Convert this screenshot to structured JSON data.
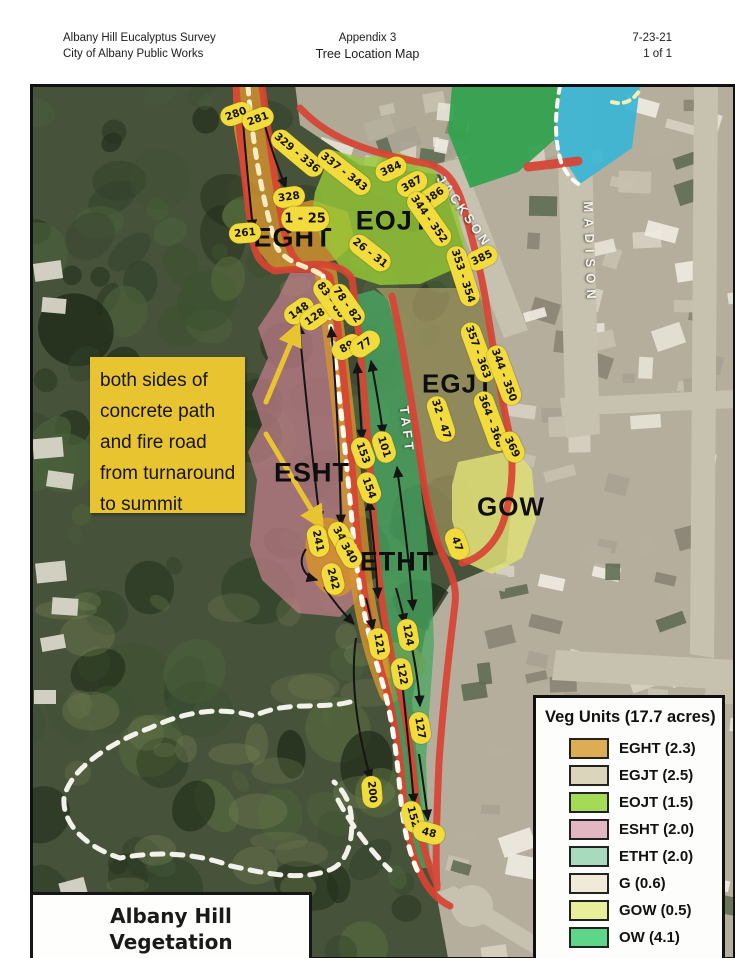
{
  "header": {
    "left_line1": "Albany Hill Eucalyptus Survey",
    "left_line2": "City of Albany Public Works",
    "center_line1": "Appendix 3",
    "center_line2": "Tree Location Map",
    "right_line1": "7-23-21",
    "right_line2": "1 of 1"
  },
  "map": {
    "callout": {
      "lines": [
        "both sides of",
        "concrete path",
        "and fire road",
        "from turnaround",
        "to summit"
      ]
    },
    "zone_labels": [
      {
        "text": "EGHT",
        "x": 293,
        "y": 238,
        "size": 27
      },
      {
        "text": "EOJT",
        "x": 393,
        "y": 221,
        "size": 27
      },
      {
        "text": "EGJT",
        "x": 458,
        "y": 384,
        "size": 26
      },
      {
        "text": "ESHT",
        "x": 312,
        "y": 473,
        "size": 27
      },
      {
        "text": "ETHT",
        "x": 397,
        "y": 562,
        "size": 27
      },
      {
        "text": "GOW",
        "x": 511,
        "y": 507,
        "size": 26
      }
    ],
    "street_labels": [
      {
        "text": "JACKSON",
        "x": 464,
        "y": 211,
        "rot": 55,
        "ls": 3
      },
      {
        "text": "MADISON",
        "x": 590,
        "y": 253,
        "rot": 88,
        "ls": 6
      },
      {
        "text": "TAFT",
        "x": 407,
        "y": 430,
        "rot": 83,
        "ls": 4
      }
    ],
    "tree_labels": [
      {
        "text": "280",
        "x": 236,
        "y": 114,
        "rot": -20
      },
      {
        "text": "281",
        "x": 258,
        "y": 119,
        "rot": -20
      },
      {
        "text": "329 - 336",
        "x": 297,
        "y": 153,
        "rot": 40
      },
      {
        "text": "328",
        "x": 289,
        "y": 197,
        "rot": -8
      },
      {
        "text": "1 - 25",
        "x": 305,
        "y": 219,
        "rot": 0,
        "big": true
      },
      {
        "text": "261",
        "x": 245,
        "y": 233,
        "rot": -5
      },
      {
        "text": "337 - 343",
        "x": 344,
        "y": 172,
        "rot": 38
      },
      {
        "text": "384",
        "x": 391,
        "y": 169,
        "rot": -25
      },
      {
        "text": "387",
        "x": 412,
        "y": 184,
        "rot": -30
      },
      {
        "text": "386",
        "x": 434,
        "y": 196,
        "rot": -35
      },
      {
        "text": "344 - 352",
        "x": 429,
        "y": 219,
        "rot": 55
      },
      {
        "text": "385",
        "x": 482,
        "y": 258,
        "rot": -25
      },
      {
        "text": "353 - 354",
        "x": 463,
        "y": 276,
        "rot": 72
      },
      {
        "text": "26 - 31",
        "x": 370,
        "y": 253,
        "rot": 38
      },
      {
        "text": "148",
        "x": 299,
        "y": 311,
        "rot": -35
      },
      {
        "text": "128",
        "x": 315,
        "y": 317,
        "rot": -35
      },
      {
        "text": "83 - 88",
        "x": 331,
        "y": 300,
        "rot": 55
      },
      {
        "text": "78 - 82",
        "x": 347,
        "y": 305,
        "rot": 55
      },
      {
        "text": "89",
        "x": 347,
        "y": 347,
        "rot": -30
      },
      {
        "text": "77",
        "x": 365,
        "y": 344,
        "rot": -35
      },
      {
        "text": "153",
        "x": 363,
        "y": 453,
        "rot": 70
      },
      {
        "text": "101",
        "x": 384,
        "y": 447,
        "rot": 72
      },
      {
        "text": "154",
        "x": 369,
        "y": 488,
        "rot": 70
      },
      {
        "text": "32 - 47",
        "x": 441,
        "y": 419,
        "rot": 72
      },
      {
        "text": "357 - 363",
        "x": 478,
        "y": 352,
        "rot": 70
      },
      {
        "text": "344 - 350",
        "x": 504,
        "y": 375,
        "rot": 70
      },
      {
        "text": "364 - 368",
        "x": 491,
        "y": 421,
        "rot": 70
      },
      {
        "text": "369",
        "x": 512,
        "y": 447,
        "rot": 65
      },
      {
        "text": "47",
        "x": 457,
        "y": 544,
        "rot": 70
      },
      {
        "text": "241",
        "x": 318,
        "y": 541,
        "rot": 78
      },
      {
        "text": "341",
        "x": 341,
        "y": 537,
        "rot": 60
      },
      {
        "text": "340",
        "x": 349,
        "y": 553,
        "rot": 60
      },
      {
        "text": "242",
        "x": 333,
        "y": 579,
        "rot": 75
      },
      {
        "text": "121",
        "x": 379,
        "y": 644,
        "rot": 80
      },
      {
        "text": "124",
        "x": 408,
        "y": 635,
        "rot": 80
      },
      {
        "text": "122",
        "x": 402,
        "y": 674,
        "rot": 80
      },
      {
        "text": "127",
        "x": 420,
        "y": 728,
        "rot": 80
      },
      {
        "text": "200",
        "x": 372,
        "y": 792,
        "rot": 85
      },
      {
        "text": "152",
        "x": 413,
        "y": 817,
        "rot": 75
      },
      {
        "text": "48",
        "x": 429,
        "y": 833,
        "rot": 15
      }
    ],
    "caption": {
      "line1": "Albany Hill",
      "line2": "Vegetation Management Plan"
    }
  },
  "legend": {
    "title": "Veg Units (17.7 acres)",
    "items": [
      {
        "label": "EGHT (2.3)",
        "color": "#ddad55"
      },
      {
        "label": "EGJT (2.5)",
        "color": "#dbd5bb"
      },
      {
        "label": "EOJT (1.5)",
        "color": "#a4da57"
      },
      {
        "label": "ESHT (2.0)",
        "color": "#e2b7c1"
      },
      {
        "label": "ETHT (2.0)",
        "color": "#a8dabd"
      },
      {
        "label": "G (0.6)",
        "color": "#f1ead8"
      },
      {
        "label": "GOW (0.5)",
        "color": "#e9ee9a"
      },
      {
        "label": "OW (4.1)",
        "color": "#5ed689"
      }
    ]
  },
  "colors": {
    "zone_eght": "#d6932f",
    "zone_eojt": "#97cb37",
    "zone_egjt": "#b4a66d",
    "zone_esht": "#c8808f",
    "zone_etht": "#4aa663",
    "zone_gow": "#dfdf78",
    "zone_ow": "#2fa24d",
    "zone_teal": "#3ab5d5",
    "road_red": "#d84434",
    "label_yellow": "#f2dc3d",
    "callout_yellow": "#e9c431"
  }
}
